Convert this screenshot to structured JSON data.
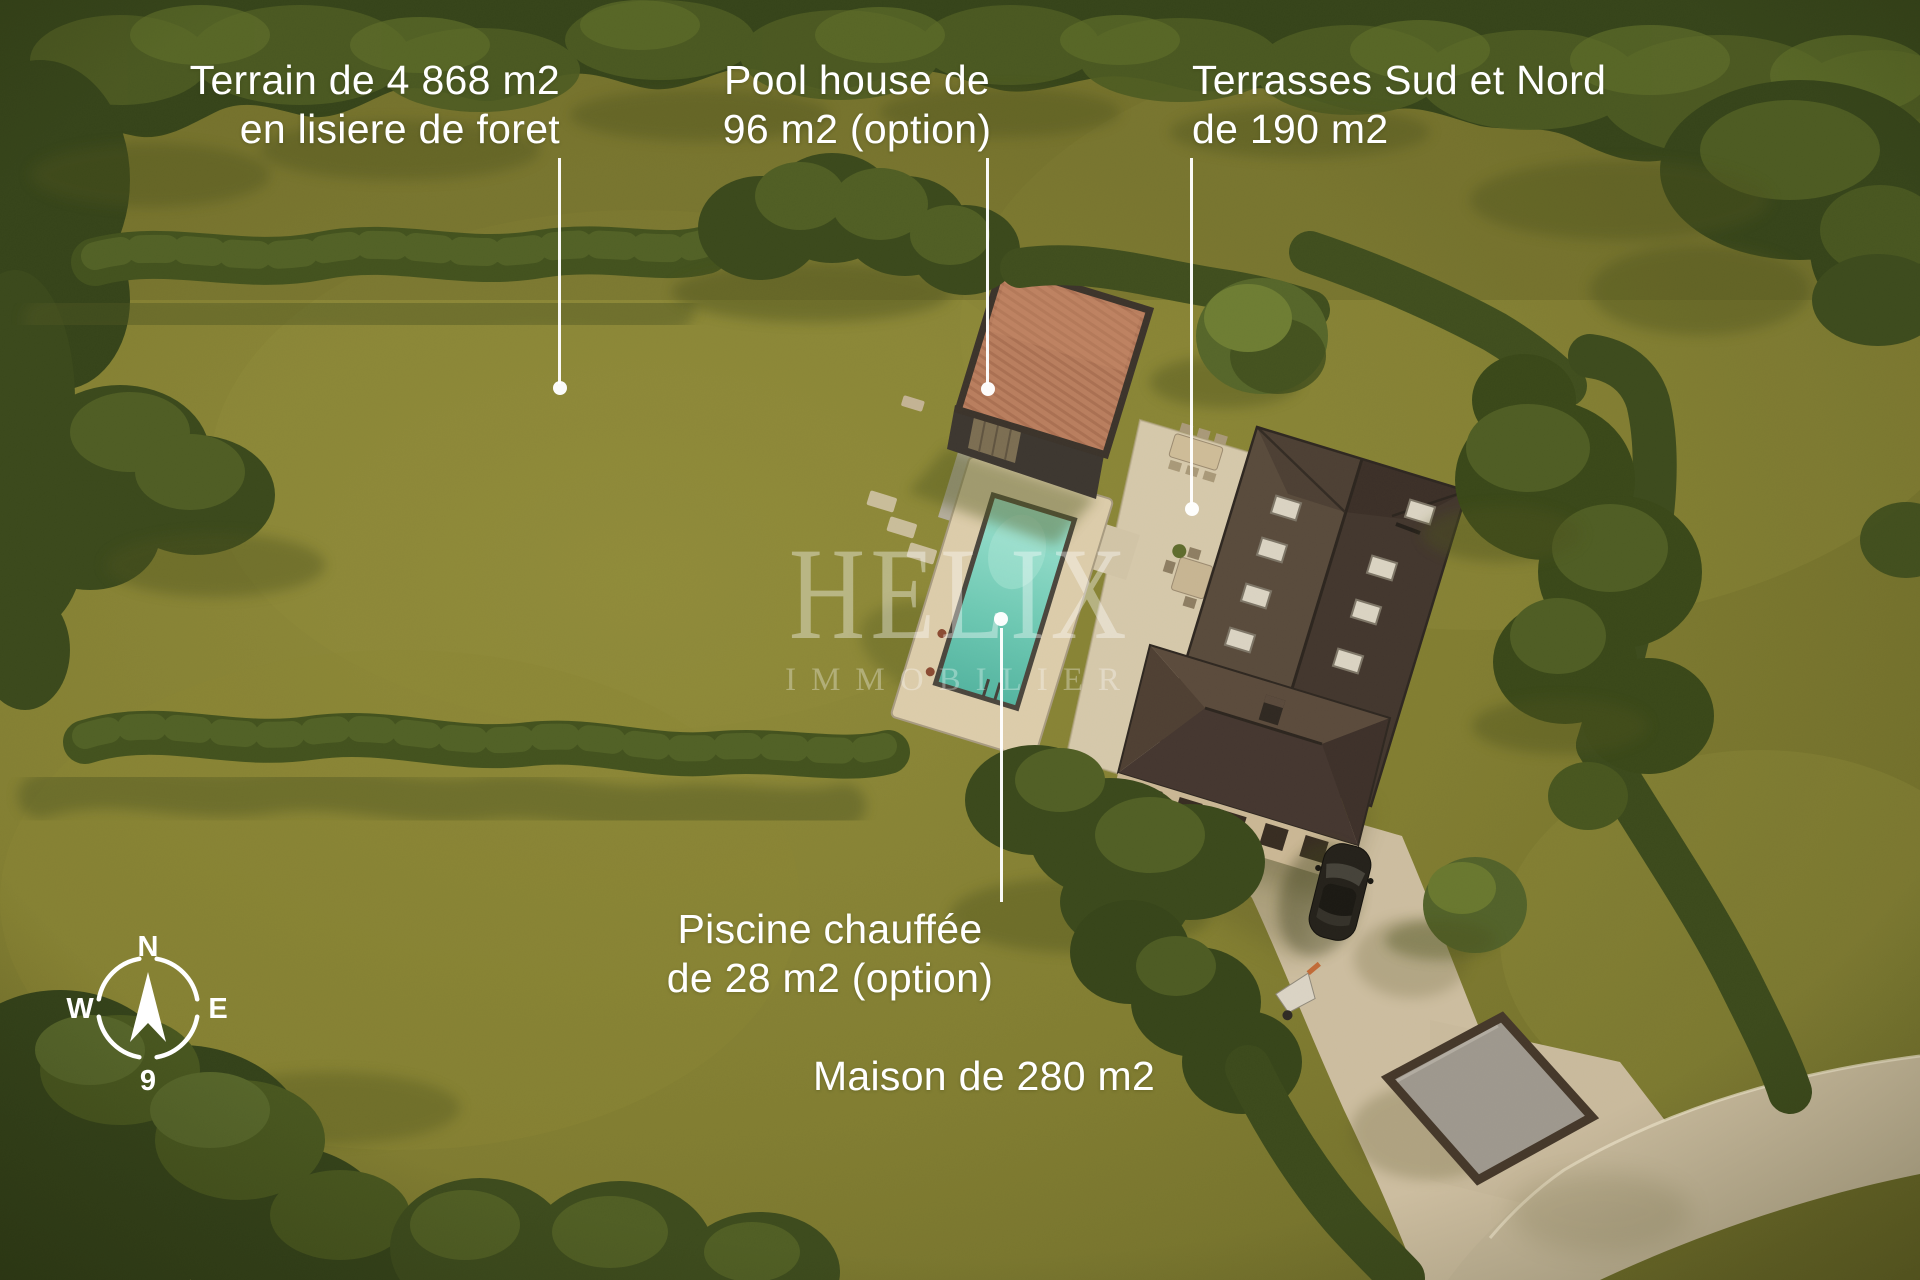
{
  "annotations": {
    "terrain": {
      "line1": "Terrain de 4 868 m2",
      "line2": "en lisiere de foret"
    },
    "pool_house": {
      "line1": "Pool house de",
      "line2": "96 m2 (option)"
    },
    "terraces": {
      "line1": "Terrasses Sud et Nord",
      "line2": "de 190 m2"
    },
    "pool": {
      "line1": "Piscine chauffée",
      "line2": "de 28 m2 (option)"
    },
    "house": {
      "line1": "Maison de 280 m2"
    }
  },
  "watermark": {
    "brand": "HELIX",
    "tagline": "IMMOBILIER"
  },
  "compass": {
    "n": "N",
    "e": "E",
    "w": "W",
    "s": "9"
  },
  "colors": {
    "lawn": "#7f7b30",
    "forest": "#35431a",
    "hedge": "#42511e",
    "house_roof": "#4a3c31",
    "pool_house_roof": "#b87d5e",
    "pool_water": "#6cc7b2",
    "paving": "#cbbc9f",
    "annotation_text": "#ffffff"
  }
}
